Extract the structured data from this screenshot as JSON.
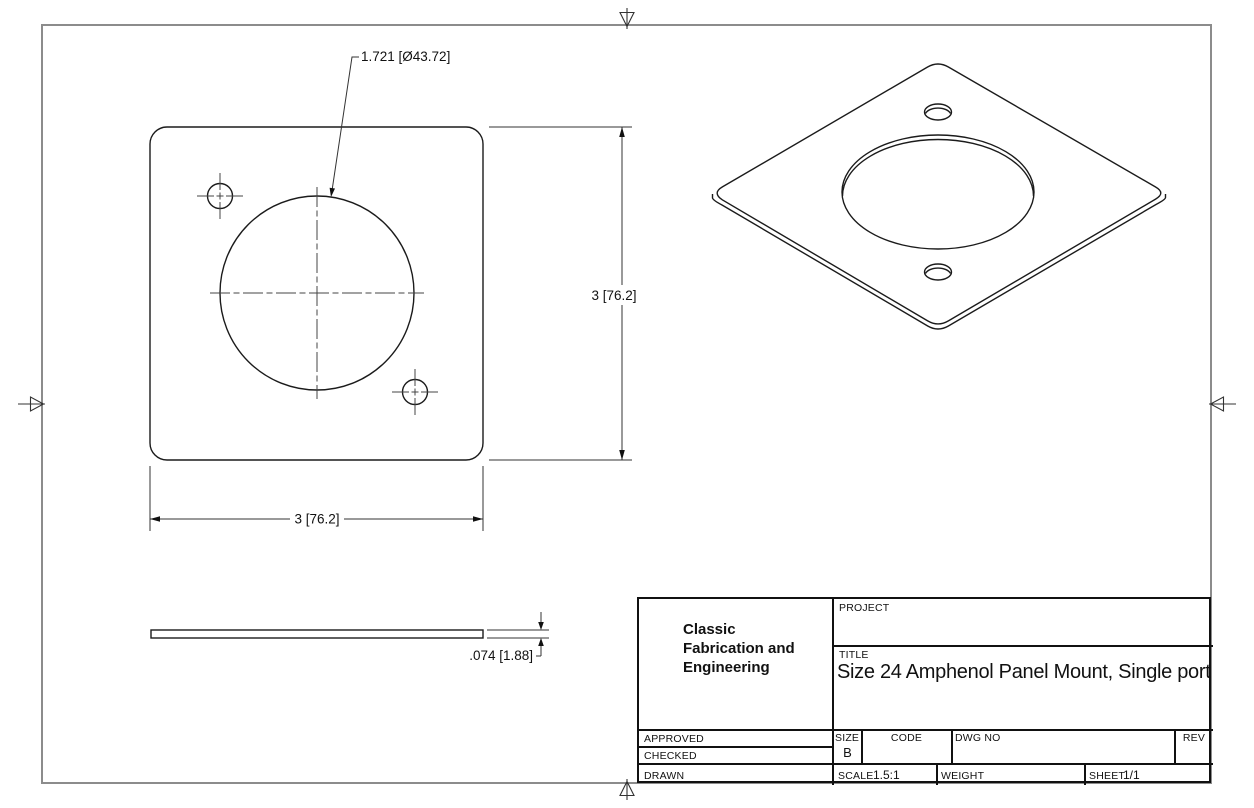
{
  "title_block": {
    "company_lines": [
      "Classic",
      "Fabrication and",
      "Engineering"
    ],
    "project_label": "PROJECT",
    "title_label": "TITLE",
    "title_value": "Size 24 Amphenol Panel Mount, Single port",
    "approved_label": "APPROVED",
    "checked_label": "CHECKED",
    "drawn_label": "DRAWN",
    "size_label": "SIZE",
    "size_value": "B",
    "code_label": "CODE",
    "dwg_no_label": "DWG NO",
    "rev_label": "REV",
    "scale_label": "SCALE",
    "scale_value": "1.5:1",
    "weight_label": "WEIGHT",
    "sheet_label": "SHEET",
    "sheet_value": "1/1"
  },
  "dimensions": {
    "hole_diameter": "1.721 [Ø43.72]",
    "plate_height": "3 [76.2]",
    "plate_width": "3 [76.2]",
    "plate_thickness": ".074 [1.88]"
  },
  "colors": {
    "line": "#1b1b1b",
    "thin_line": "#333333",
    "frame": "#8c8c8c",
    "background": "#ffffff"
  }
}
